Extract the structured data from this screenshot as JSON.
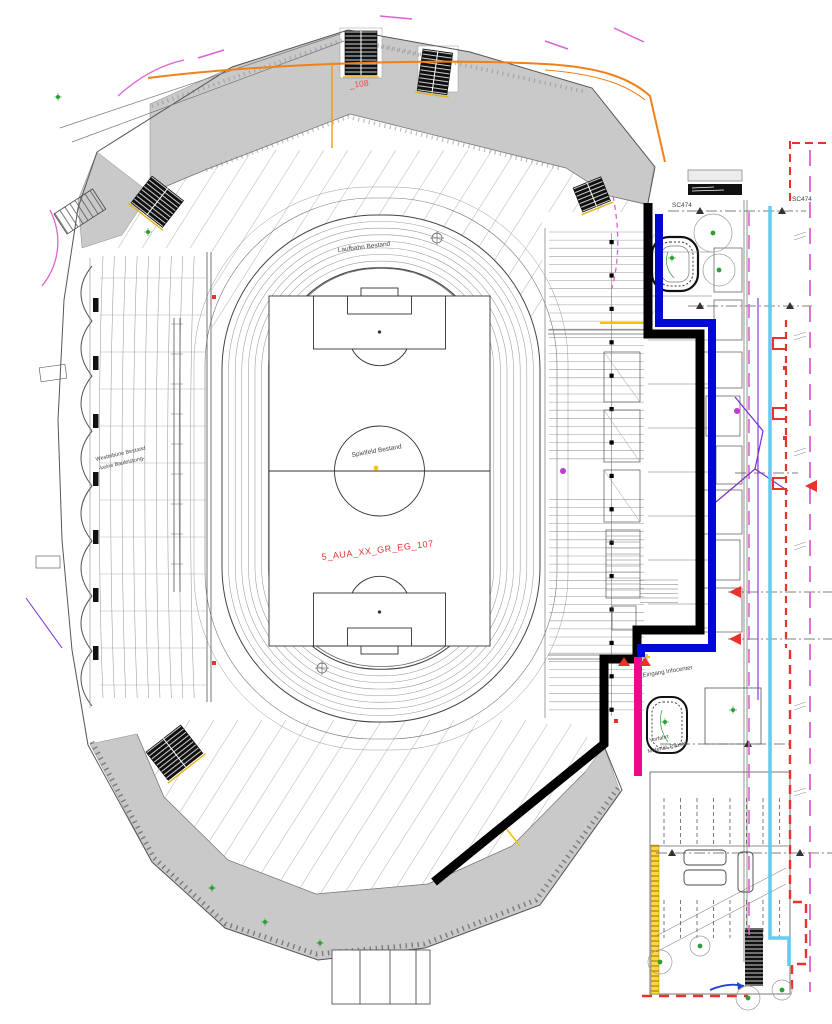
{
  "drawing": {
    "track_label": "Laufbahn Bestand",
    "field_label": "Spielfeld Bestand",
    "plan_ref_main": "5_AUA_XX_GR_EG_107",
    "plan_ref_top": "_108",
    "west_stand_line1": "Westtribüne Bestand",
    "west_stand_line2": "-keine Bauleistung-",
    "entrance_label": "Eingang Infocenter",
    "forecourt_line1": "Vorfahrt",
    "forecourt_line2": "Material, Pflaster",
    "grid_axis_left": "SC474",
    "grid_axis_right": "SC474"
  },
  "colors": {
    "boundary_black": "#000000",
    "boundary_blue": "#0008d8",
    "boundary_magenta": "#ea0a8c",
    "utility_cyan": "#5fc8ef",
    "limit_red": "#e8322a",
    "path_orange": "#f08019",
    "tree_green": "#2e9e36",
    "band_gray": "#c9c9c9"
  }
}
